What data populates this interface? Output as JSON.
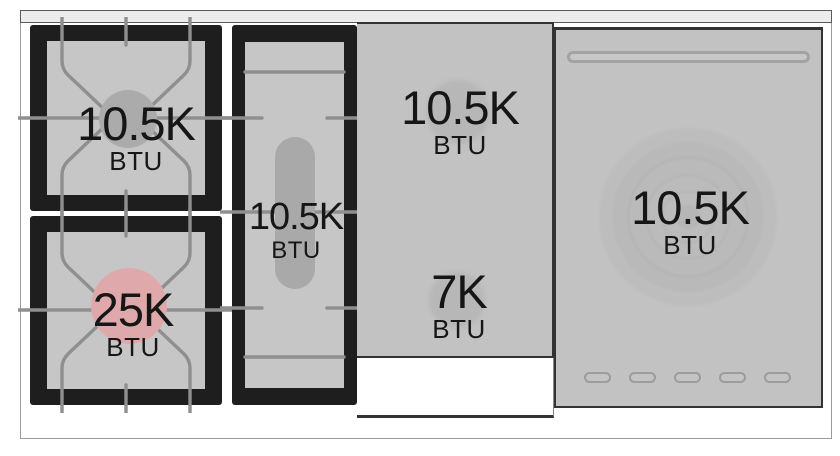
{
  "zones": [
    {
      "name": "left-rear-gas-burner",
      "power": "10.5K",
      "unit": "BTU",
      "highlighted": false
    },
    {
      "name": "left-front-gas-burner",
      "power": "25K",
      "unit": "BTU",
      "highlighted": true
    },
    {
      "name": "center-oval-burner",
      "power": "10.5K",
      "unit": "BTU",
      "highlighted": false
    },
    {
      "name": "griddle-rear-zone",
      "power": "10.5K",
      "unit": "BTU",
      "highlighted": false
    },
    {
      "name": "griddle-front-zone",
      "power": "7K",
      "unit": "BTU",
      "highlighted": false
    },
    {
      "name": "right-cooking-zone",
      "power": "10.5K",
      "unit": "BTU",
      "highlighted": false
    }
  ],
  "colors": {
    "highlighted_burner": "#dfa9ac",
    "burner_circle": "#ababab",
    "module_frame": "#1e1e1e",
    "module_surface": "#c6c6c6",
    "panel_surface": "#c2c2c2",
    "grate_line": "#8f8f8f",
    "text": "#161616"
  }
}
